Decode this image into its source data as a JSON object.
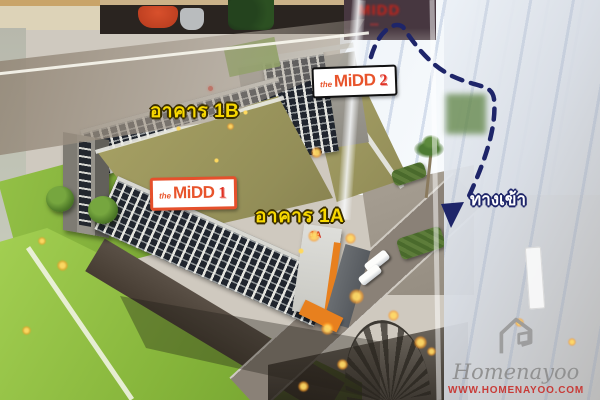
{
  "labels": {
    "building_1b": "อาคาร 1B",
    "building_1a": "อาคาร 1A",
    "entrance": "ทางเข้า",
    "wall_text_1a": "1A"
  },
  "logos": {
    "midd_1": {
      "prefix": "the",
      "name": "MiDD",
      "number": "1"
    },
    "midd_2": {
      "prefix": "the",
      "name": "MiDD",
      "number": "2"
    }
  },
  "background": {
    "showroom_sign_text": "MIDD"
  },
  "watermark": {
    "brand": "Homenayoo",
    "url": "WWW.HOMENAYOO.COM"
  },
  "colors": {
    "label_yellow": "#f8d800",
    "logo_orange": "#e8542c",
    "logo_red": "#e03022",
    "arrow_navy": "#1e2569",
    "watermark_red": "#c8302c",
    "lawn_green": "#8fbf3f",
    "courtyard_olive": "#9d9760"
  }
}
